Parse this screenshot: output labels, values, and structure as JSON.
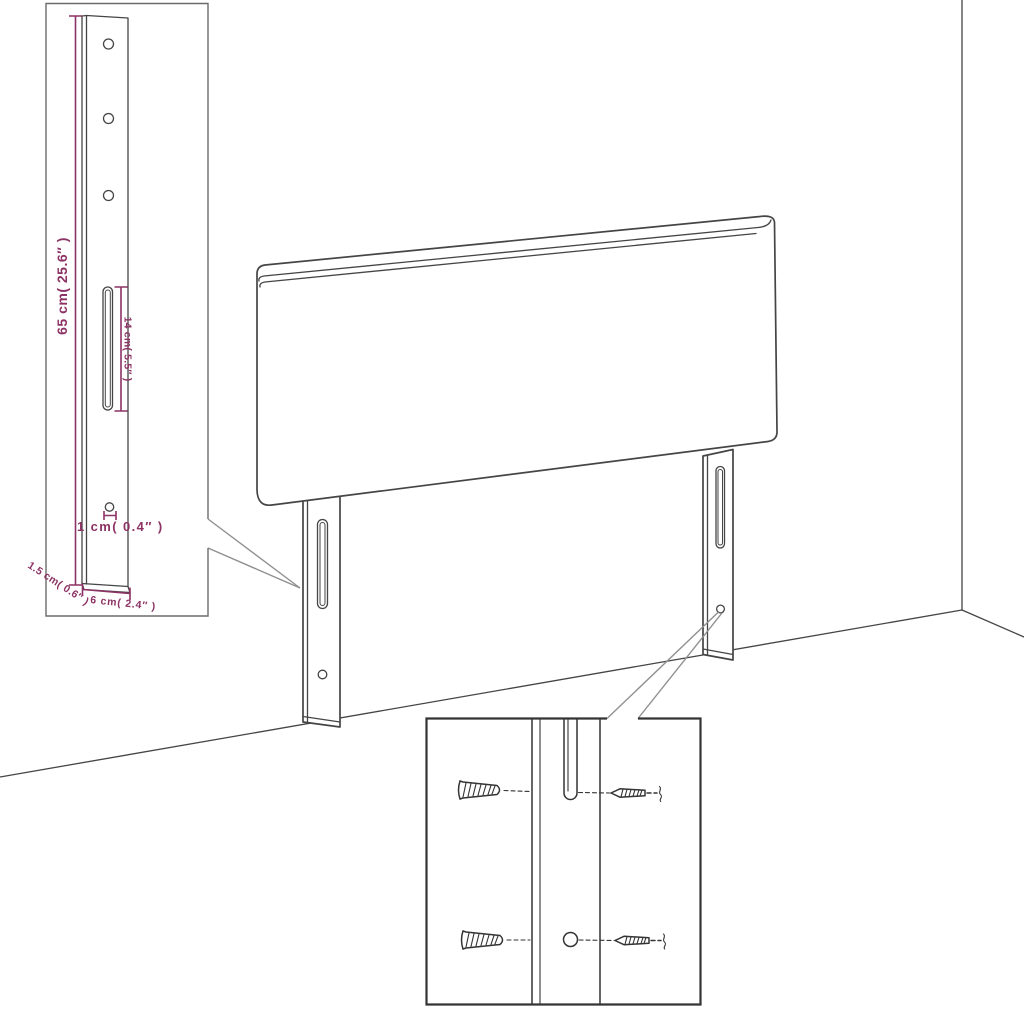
{
  "colors": {
    "dimension": "#8c3264",
    "outline": "#454545",
    "leader": "#909090",
    "callout_border": "#343434",
    "background": "#ffffff"
  },
  "detail_bracket": {
    "labels": {
      "height": "65 cm( 25.6″ )",
      "slot_length": "14 cm( 5.5″ )",
      "hole_offset": "1 cm( 0.4″ )",
      "thickness": "1.5 cm( 0.6″ )",
      "width": "6 cm( 2.4″ )"
    }
  },
  "fastener_detail": {
    "icons": [
      "wall-plug-icon",
      "screw-icon"
    ]
  }
}
